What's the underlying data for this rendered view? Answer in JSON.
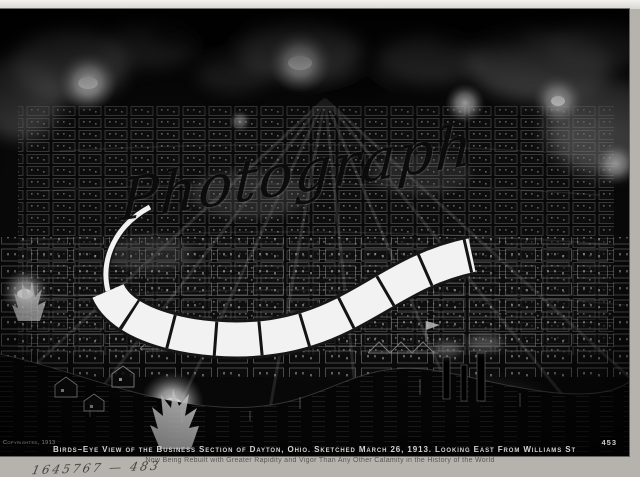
{
  "photo": {
    "watermark_text": "Photograph",
    "caption_line1": "Birds–Eye View of the Business Section of Dayton, Ohio.   Sketched March 26, 1913. Looking East From Williams St",
    "copyright_notice": "Copyrighted, 1913",
    "plate_number": "453"
  },
  "mat": {
    "caption_line2": "Now Being Rebuilt with Greater Rapidity and Vigor Than Any Other Calamity in the History of the World",
    "handwritten_number": "1645767 — 483"
  },
  "colors": {
    "mat": "#b6b3ae",
    "photo_background": "#0a0a0a",
    "caption_text": "#d6d4d0",
    "subcaption_text": "#585650",
    "smoke_gray": "#8e8e8e",
    "filmstrip_white": "#f2f2f2"
  }
}
